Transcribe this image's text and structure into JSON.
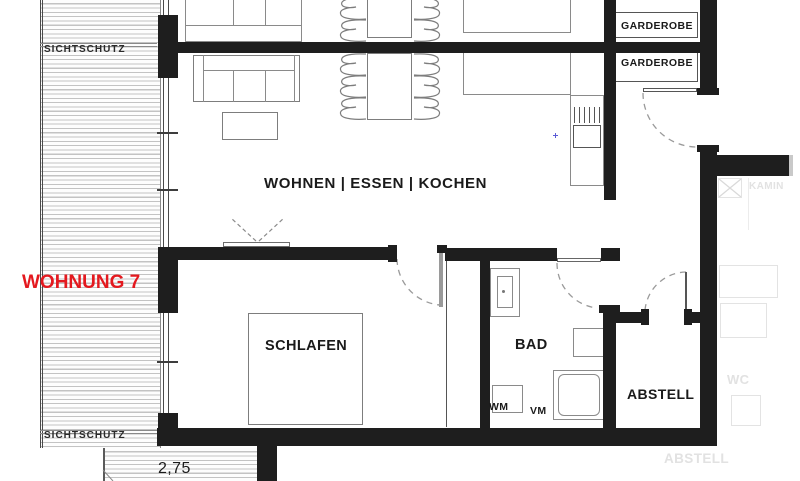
{
  "plan": {
    "apartment_label": "WOHNUNG 7",
    "rooms": {
      "living": "WOHNEN | ESSEN | KOCHEN",
      "bedroom": "SCHLAFEN",
      "bathroom": "BAD",
      "storage": "ABSTELL",
      "wardrobe_top": "GARDEROBE",
      "wardrobe_bottom": "GARDEROBE"
    },
    "appliances": {
      "washing_machine": "WM",
      "dryer": "VM"
    },
    "privacy_screen_top": "SICHTSCHUTZ",
    "privacy_screen_bottom": "SICHTSCHUTZ",
    "balcony_dimension": "2,75",
    "neighbor_unit": {
      "fireplace": "KAMIN",
      "wc": "WC",
      "storage": "ABSTELL"
    },
    "colors": {
      "wall": "#1e1e1e",
      "accent_red": "#e4191f",
      "faint_gray": "#e2e2e2",
      "marker_blue": "#5b5bd6"
    }
  }
}
